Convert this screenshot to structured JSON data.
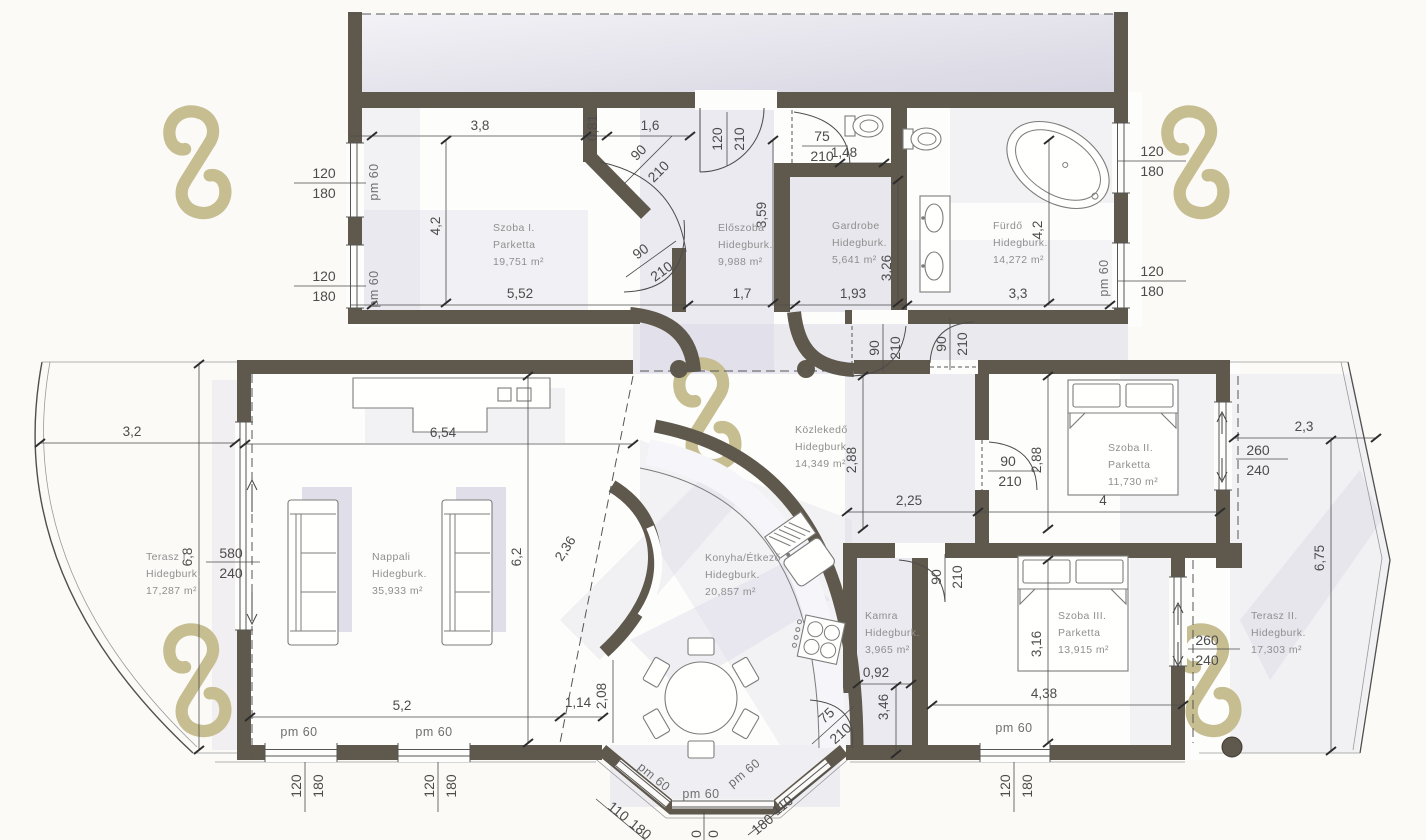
{
  "drawing": {
    "type": "architectural floor plan",
    "language": "Hungarian"
  },
  "colors": {
    "wall": "#5f584c",
    "tint": "#d9d8e5",
    "watermark": "#c6bd90",
    "line": "#4c4c4c",
    "room_text": "#8f8f8f",
    "background": "#fbfaf7"
  },
  "rooms": {
    "szoba1": {
      "name": "Szoba I.",
      "finish": "Parketta",
      "area": "19,751 m²"
    },
    "eloszoba": {
      "name": "Előszoba",
      "finish": "Hidegburk.",
      "area": "9,988 m²"
    },
    "gardrobe": {
      "name": "Gardrobe",
      "finish": "Hidegburk.",
      "area": "5,641 m²"
    },
    "furdo": {
      "name": "Fürdő",
      "finish": "Hidegburk.",
      "area": "14,272 m²"
    },
    "kozlekedo": {
      "name": "Közlekedő",
      "finish": "Hidegburk.",
      "area": "14,349 m²"
    },
    "szoba2": {
      "name": "Szoba II.",
      "finish": "Parketta",
      "area": "11,730 m²"
    },
    "nappali": {
      "name": "Nappali",
      "finish": "Hidegburk.",
      "area": "35,933 m²"
    },
    "konyha": {
      "name": "Konyha/Étkező",
      "finish": "Hidegburk.",
      "area": "20,857 m²"
    },
    "kamra": {
      "name": "Kamra",
      "finish": "Hidegburk.",
      "area": "3,965 m²"
    },
    "szoba3": {
      "name": "Szoba III.",
      "finish": "Parketta",
      "area": "13,915 m²"
    },
    "terasz1": {
      "name": "Terasz I.",
      "finish": "Hidegburk.",
      "area": "17,287 m²"
    },
    "terasz2": {
      "name": "Terasz II.",
      "finish": "Hidegburk.",
      "area": "17,303 m²"
    }
  },
  "dims": {
    "d38": "3,8",
    "d081": "0,81",
    "d16": "1,6",
    "d42": "4,2",
    "d552": "5,52",
    "d17": "1,7",
    "d193": "1,93",
    "d33": "3,3",
    "d359": "3,59",
    "d148": "1,48",
    "d326": "3,26",
    "d32": "3,2",
    "d654": "6,54",
    "d23": "2,3",
    "d288": "2,88",
    "d225": "2,25",
    "d4": "4",
    "d62": "6,2",
    "d236": "2,36",
    "d68": "6,8",
    "d675": "6,75",
    "d52": "5,2",
    "d114": "1,14",
    "d208": "2,08",
    "d092": "0,92",
    "d346": "3,46",
    "d316": "3,16",
    "d438": "4,38"
  },
  "openings": {
    "pm60": "pm 60",
    "n120": "120",
    "n180": "180",
    "n210": "210",
    "n90": "90",
    "n75": "75",
    "n110": "110",
    "n240": "240",
    "n260": "260",
    "n580": "580",
    "cut0": "0"
  }
}
